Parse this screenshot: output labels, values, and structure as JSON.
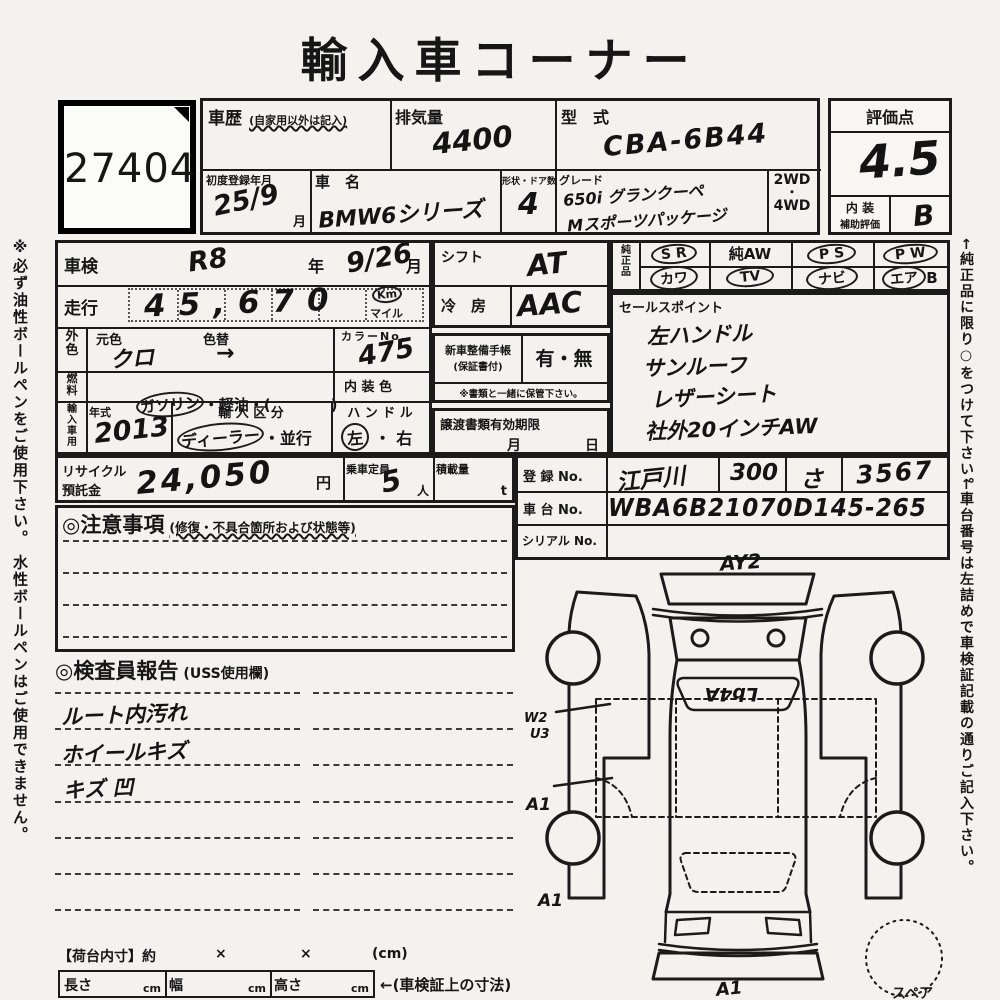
{
  "title": "輸入車コーナー",
  "lot": {
    "mark": "N-",
    "number": "27404"
  },
  "sidebar": {
    "left": "※必ず油性ボールペンをご使用下さい。 水性ボールペンはご使用できません。",
    "right_top": "←純正品に限り○をつけて下さい。",
    "right_bottom": "←車台番号は左詰めで車検証記載の通りご記入下さい。"
  },
  "top": {
    "shareki_label": "車歴",
    "shareki_note": "(自家用以外は記入)",
    "haikiryo_label": "排気量",
    "haikiryo_value": "4400",
    "katashiki_label": "型　式",
    "katashiki_value": "CBA-6B44",
    "shodo_label": "初度登録年月",
    "shodo_value": "25/9",
    "shodo_unit": "月",
    "shamei_label": "車　名",
    "shamei_value": "BMW6シリーズ",
    "keijo_label": "形状・ドア数",
    "keijo_value": "4",
    "grade_label": "グレード",
    "grade_line1": "650i グランクーペ",
    "grade_line2": "Mスポーツパッケージ",
    "drive_2wd": "2WD",
    "drive_dot": "・",
    "drive_4wd": "4WD"
  },
  "rating": {
    "label": "評価点",
    "score": "4.5",
    "interior_label_1": "内 装",
    "interior_label_2": "補助評価",
    "interior_value": "B"
  },
  "left_col": {
    "shaken_label": "車検",
    "shaken_year": "R8",
    "year_unit": "年",
    "shaken_date": "9/26",
    "month_unit": "月",
    "mileage_label": "走行",
    "mileage_value": "45,670",
    "km": "Km",
    "mile": "マイル",
    "gaishoku_label": "外色",
    "motoiro_label": "元色",
    "motoiro_value": "クロ",
    "irokae_label": "色替",
    "irokae_value": "→",
    "colorno_label": "カラーNo.",
    "colorno_value": "475",
    "fuel_label": "燃料",
    "fuel_opt1": "ガソリン",
    "fuel_rest": "・軽油・(　　　　)",
    "naishoku_label": "内 装 色",
    "import_label": "輸入車用",
    "nenshiki_label": "年式",
    "nenshiki_value": "2013",
    "kubun_label": "輸 入 区 分",
    "kubun_opt1": "ディーラー",
    "kubun_rest": "・並行",
    "handle_label": "ハ ン ド ル",
    "handle_left": "左",
    "handle_dot": "・",
    "handle_right": "右"
  },
  "mid_col": {
    "shift_label": "シフト",
    "shift_value": "AT",
    "aircon_label": "冷　房",
    "aircon_value": "AAC",
    "techo_label_1": "新車整備手帳",
    "techo_label_2": "(保証書付)",
    "techo_value": "有・無",
    "keep_note": "※書類と一緒に保管下さい。",
    "joto_label": "譲渡書類有効期限",
    "joto_month": "月",
    "joto_day": "日"
  },
  "genuine": {
    "label": "純正品",
    "r1c1": "S R",
    "r1c2": "純AW",
    "r1c3": "P S",
    "r1c4": "P W",
    "r2c1": "カワ",
    "r2c2": "TV",
    "r2c3": "ナビ",
    "r2c4_circ": "エア",
    "r2c4_rest": "B"
  },
  "sales": {
    "label": "セールスポイント",
    "items": [
      "左ハンドル",
      "サンルーフ",
      "レザーシート",
      "社外20インチAW"
    ]
  },
  "recycle": {
    "label_1": "リサイクル",
    "label_2": "預託金",
    "value": "24,050",
    "unit": "円",
    "teiin_label": "乗車定員",
    "teiin_value": "5",
    "teiin_unit": "人",
    "load_label": "積載量",
    "load_unit": "t"
  },
  "registration": {
    "touroku_label": "登 録 No.",
    "v1": "江戸川",
    "v2": "300",
    "v3": "さ",
    "v4": "3567",
    "shadai_label": "車 台 No.",
    "shadai_value": "WBA6B21070D145-265",
    "serial_label": "シリアル No."
  },
  "notes": {
    "header": "◎注意事項",
    "note": "(修復・不具合箇所および状態等)"
  },
  "inspector": {
    "header": "◎検査員報告",
    "note": "(USS使用欄)",
    "items": [
      "ルート内汚れ",
      "ホイールキズ",
      "キズ 凹"
    ]
  },
  "diagram": {
    "top_mark": "AY2",
    "window_mark": "Lb4A",
    "mark_w2": "W2",
    "mark_u3": "U3",
    "mark_a1_left_top": "A1",
    "mark_a1_left_bottom": "A1",
    "mark_a1_front": "A1",
    "spare_label": "スペア"
  },
  "bottom": {
    "nidai_label": "【荷台内寸】約",
    "x1": "×",
    "x2": "×",
    "cm_note": "(cm)",
    "length_label": "長さ",
    "width_label": "幅",
    "height_label": "高さ",
    "unit_cm": "cm",
    "shaken_note": "←(車検証上の寸法)"
  }
}
